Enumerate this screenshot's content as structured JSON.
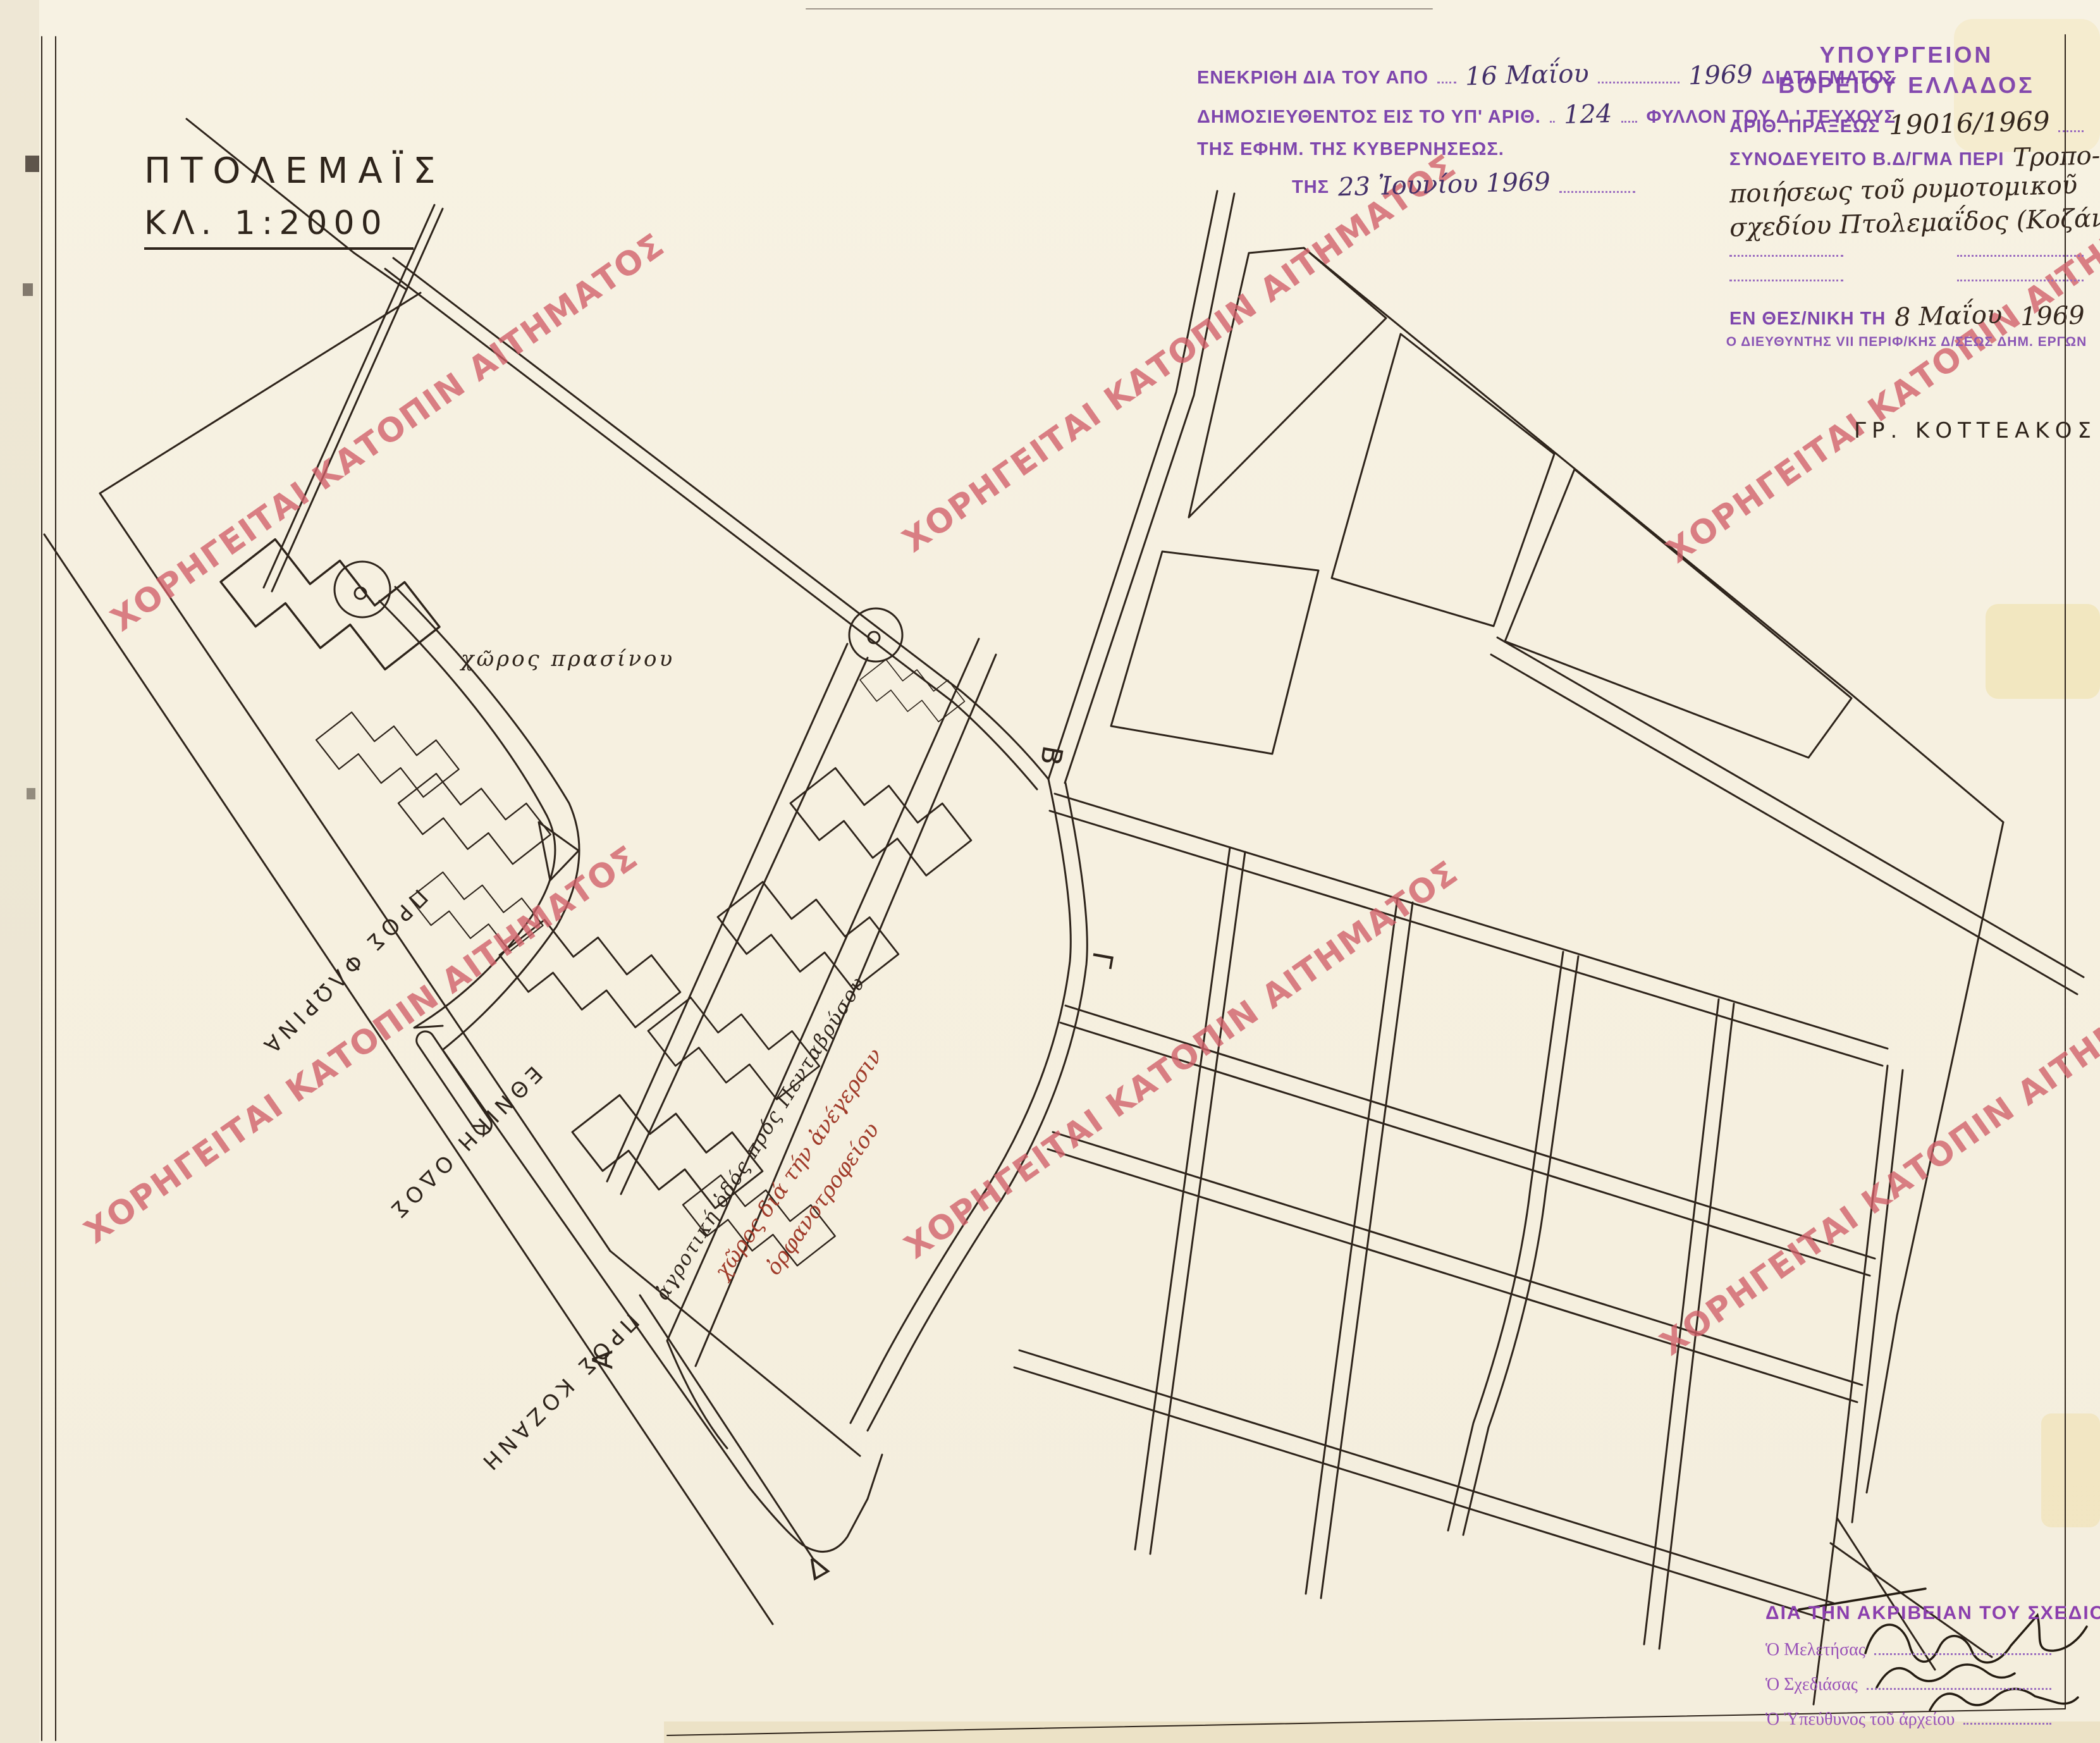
{
  "page": {
    "title": "ΠΤΟΛΕΜΑΪΣ",
    "scale": "ΚΛ. 1:2000"
  },
  "approval_stamp": {
    "l1a": "ΕΝΕΚΡΙΘΗ ΔΙΑ ΤΟΥ ΑΠΟ",
    "l1_hand": "16 Μαΐου",
    "l1_year": "1969",
    "l1b": "ΔΙΑΤΑΓΜΑΤΟΣ",
    "l2a": "ΔΗΜΟΣΙΕΥΘΕΝΤΟΣ ΕΙΣ ΤΟ ΥΠ' ΑΡΙΘ.",
    "l2_hand": "124",
    "l2b": "ΦΥΛΛΟΝ ΤΟΥ Δ.' ΤΕΥΧΟΥΣ",
    "l3": "ΤΗΣ ΕΦΗΜ. ΤΗΣ ΚΥΒΕΡΝΗΣΕΩΣ.",
    "l4a": "ΤΗΣ",
    "l4_hand": "23 Ἰουνίου 1969"
  },
  "ministry_stamp": {
    "header1": "ΥΠΟΥΡΓΕΙΟΝ",
    "header2": "ΒΟΡΕΙΟΥ ΕΛΛΑΔΟΣ",
    "act_label": "ΑΡΙΘ. ΠΡΑΞΕΩΣ",
    "act_value": "19016/1969",
    "decree_label": "ΣΥΝΟΔΕΥΕΙΤΟ Β.Δ/ΓΜΑ ΠΕΡΙ",
    "decree_hand1": "Τροπο-",
    "decree_hand2": "ποιήσεως τοῦ ρυμοτομικοῦ",
    "decree_hand3": "σχεδίου Πτολεμαΐδος (Κοζάνης)",
    "place_label": "ΕΝ ΘΕΣ/ΝΙΚΗ ΤΗ",
    "place_hand": "8 Μαΐου",
    "place_year": "1969",
    "director": "Ο ΔΙΕΥΘΥΝΤΗΣ VII ΠΕΡΙΦ/ΚΗΣ Δ/ΣΕΩΣ ΔΗΜ. ΕΡΓΩΝ"
  },
  "certification": {
    "header": "ΔΙΑ ΤΗΝ ΑΚΡΙΒΕΙΑΝ ΤΟΥ ΣΧΕΔΙΟΥ",
    "r1": "Ὁ Μελετήσας",
    "r2": "Ὁ Σχεδιάσας",
    "r3": "Ὁ Ὑπεύθυνος τοῦ ἀρχείου"
  },
  "map_labels": {
    "surveyor": "ΓΡ. ΚΟΤΤΕΑΚΟΣ",
    "green_space": "χῶρος πρασίνου",
    "rural_road": "ἀγροτική ὁδός πρός Πενταβρύσου",
    "orphanage1": "χῶρος διά τήν ἀνέγερσιν",
    "orphanage2": "ὀρφανοτροφείου",
    "to_florina": "ΠΡΟΣ ΦΛΩΡΙΝΑ",
    "national_road": "ΕΘΝΙΚΗ ΟΔΟΣ",
    "to_kozani": "ΠΡΟΣ ΚΟΖΑΝΗ",
    "pt_a": "Α",
    "pt_b": "Β",
    "pt_c": "Γ",
    "pt_d": "Δ"
  },
  "watermark": {
    "text": "ΧΟΡΗΓΕΙΤΑΙ ΚΑΤΟΠΙΝ ΑΙΤΗΜΑΤΟΣ",
    "color": "#d15f69"
  },
  "colors": {
    "ink": "#2e241b",
    "stamp_purple": "#7e46ad",
    "hand_purple": "#433069",
    "hand_ink": "#33261d",
    "red_ink": "#a03b2a",
    "paper": "#f6f1e2"
  }
}
